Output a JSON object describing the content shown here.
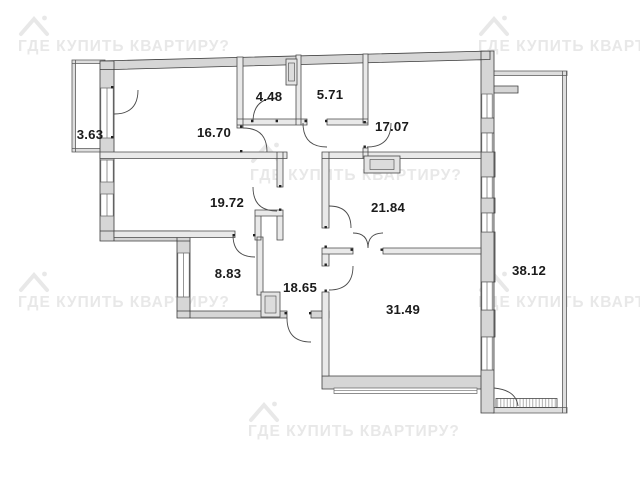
{
  "watermark": {
    "text": "ГДЕ КУПИТЬ КВАРТИРУ?",
    "color": "#e8e8e8",
    "icon": "house-icon"
  },
  "floorplan": {
    "type": "apartment-floor-plan",
    "units": "m²",
    "rooms": [
      {
        "id": "balcony-left",
        "area": "3.63"
      },
      {
        "id": "room-top-left",
        "area": "16.70"
      },
      {
        "id": "room-small-1",
        "area": "4.48"
      },
      {
        "id": "room-small-2",
        "area": "5.71"
      },
      {
        "id": "room-top-right",
        "area": "17.07"
      },
      {
        "id": "room-mid-left",
        "area": "19.72"
      },
      {
        "id": "room-mid-right",
        "area": "21.84"
      },
      {
        "id": "closet",
        "area": "8.83"
      },
      {
        "id": "hallway",
        "area": "18.65"
      },
      {
        "id": "room-bottom",
        "area": "31.49"
      },
      {
        "id": "terrace-right",
        "area": "38.12"
      }
    ],
    "colors": {
      "outer_wall_fill": "#d6d6d6",
      "inner_wall_fill": "#e9e9e9",
      "wall_stroke": "#3b3b3b",
      "label_text": "#1b1b1b",
      "background": "#ffffff"
    }
  }
}
